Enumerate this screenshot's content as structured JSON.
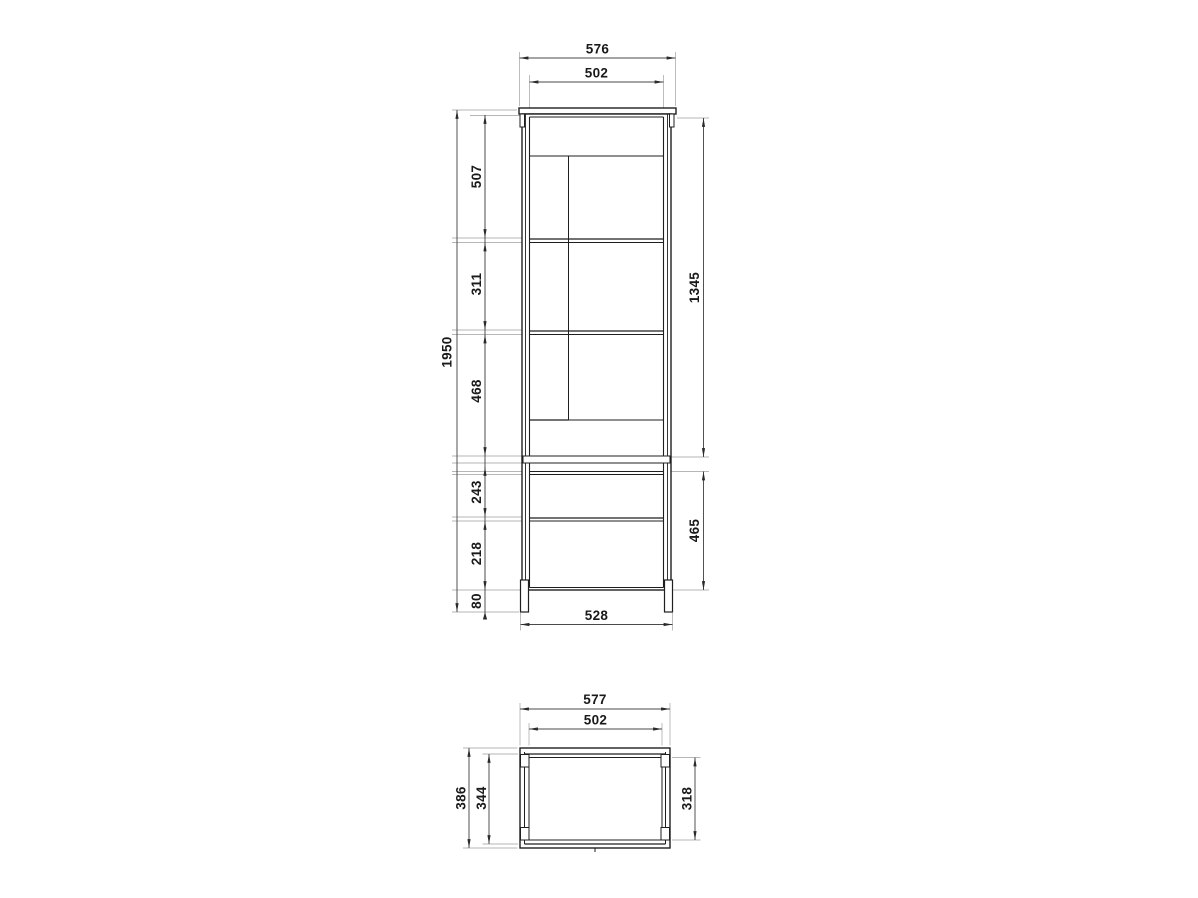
{
  "drawing": {
    "kind": "furniture-dimension-drawing",
    "views": {
      "front": {
        "name": "front-view",
        "dims": {
          "top_width_outer": "576",
          "top_width_inner": "502",
          "height_total": "1950",
          "left_chain": [
            "507",
            "311",
            "468",
            "243",
            "218",
            "80"
          ],
          "right_upper_height": "1345",
          "right_lower_height": "465",
          "bottom_width": "528"
        }
      },
      "top": {
        "name": "top-view",
        "dims": {
          "width_outer": "577",
          "width_inner": "502",
          "depth_outer": "386",
          "depth_inner_left": "344",
          "depth_inner_right": "318"
        }
      }
    },
    "colors": {
      "line_dark": "#1f1f1f",
      "line_gray": "#9a9a9a",
      "extension_line": "#b6b6b6",
      "dimension_line": "#4a4a4a",
      "text": "#1a1a1a",
      "band_fill": "#2b2b2b",
      "background": "#ffffff"
    }
  }
}
